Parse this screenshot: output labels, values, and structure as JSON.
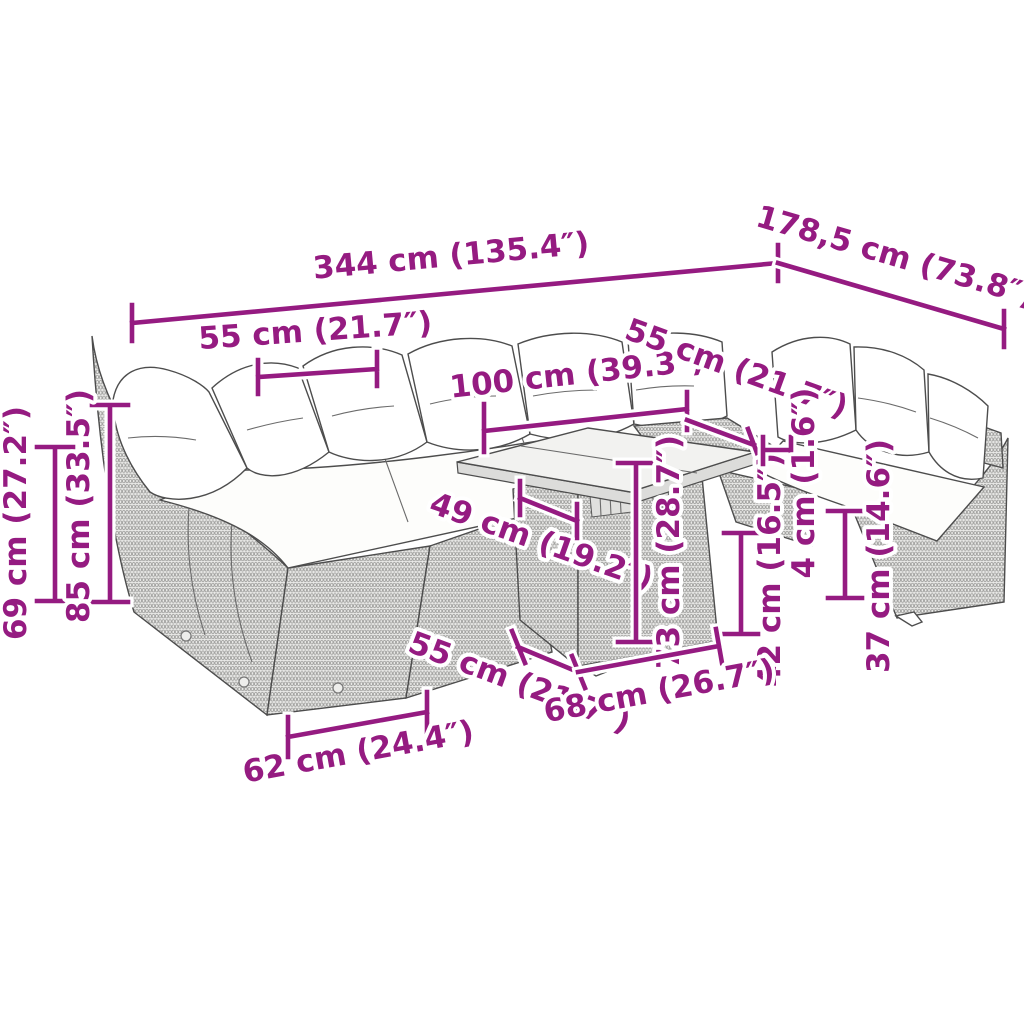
{
  "diagram": {
    "title": "Garden lounge set dimension diagram",
    "product": "Poly rattan garden sofa set with cushions and glass-top table",
    "accent_color": "#951B81",
    "outline_color": "#4d4d4d",
    "background_color": "#ffffff"
  },
  "dims": [
    {
      "name": "total-width",
      "label": "344 cm (135.4″)"
    },
    {
      "name": "right-section-depth",
      "label": "178,5 cm (73.8″)"
    },
    {
      "name": "back-seat-width",
      "label": "55 cm (21.7″)"
    },
    {
      "name": "table-length",
      "label": "100 cm (39.3″)"
    },
    {
      "name": "right-seat-width",
      "label": "55 cm (21.7″)"
    },
    {
      "name": "back-height",
      "label": "69 cm (27.2″)"
    },
    {
      "name": "total-height",
      "label": "85 cm (33.5″)"
    },
    {
      "name": "table-depth",
      "label": "49 cm (19.2″)"
    },
    {
      "name": "table-height",
      "label": "73 cm (28.7″)"
    },
    {
      "name": "seat-height",
      "label": "42 cm (16.5″)"
    },
    {
      "name": "tabletop-thickness",
      "label": "4 cm (1.6″)"
    },
    {
      "name": "base-height",
      "label": "37 cm (14.6″)"
    },
    {
      "name": "seat-depth",
      "label": "55 cm (21.7″)"
    },
    {
      "name": "table-base-width",
      "label": "68 cm (26.7″)"
    },
    {
      "name": "front-module-width",
      "label": "62 cm (24.4″)"
    }
  ]
}
